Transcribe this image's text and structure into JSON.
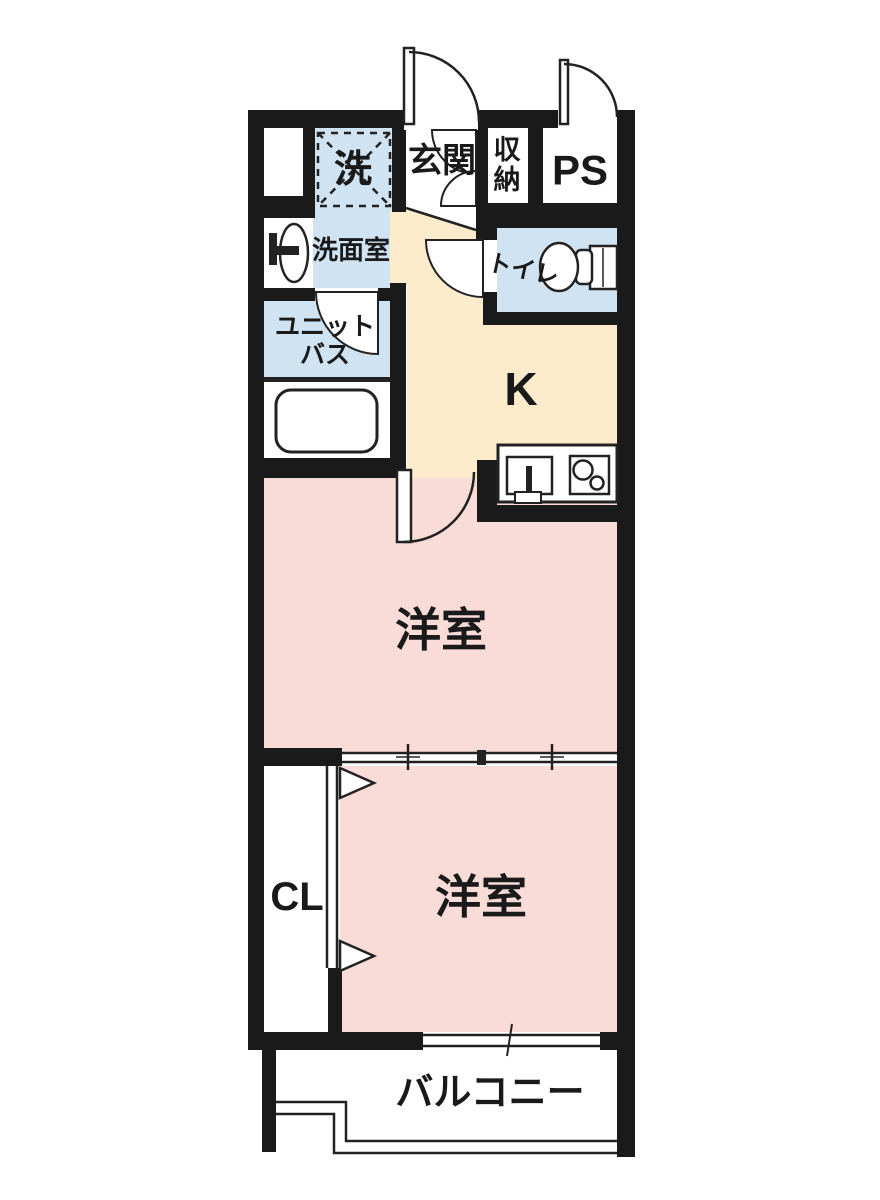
{
  "floorplan": {
    "rooms": {
      "laundry": "洗",
      "entrance": "玄関",
      "storage": "収納",
      "pipe_space": "PS",
      "washroom": "洗面室",
      "toilet": "トイレ",
      "unit_bath": [
        "ユニット",
        "バス"
      ],
      "kitchen": "K",
      "western_room_upper": "洋室",
      "closet": "CL",
      "western_room_lower": "洋室",
      "balcony": "バルコニー"
    },
    "colors": {
      "wall": "#1a1a1a",
      "line": "#222222",
      "room_pink": "#f9dcd8",
      "kitchen_cream": "#fdeccb",
      "wet_blue": "#d0e3f2",
      "background": "#ffffff"
    },
    "icons": [
      "washing-machine-area-icon",
      "washbasin-icon",
      "bathtub-icon",
      "toilet-icon",
      "kitchen-sink-icon",
      "stove-icon",
      "door-swing-icon",
      "sliding-door-icon",
      "folding-door-icon",
      "window-icon"
    ]
  }
}
